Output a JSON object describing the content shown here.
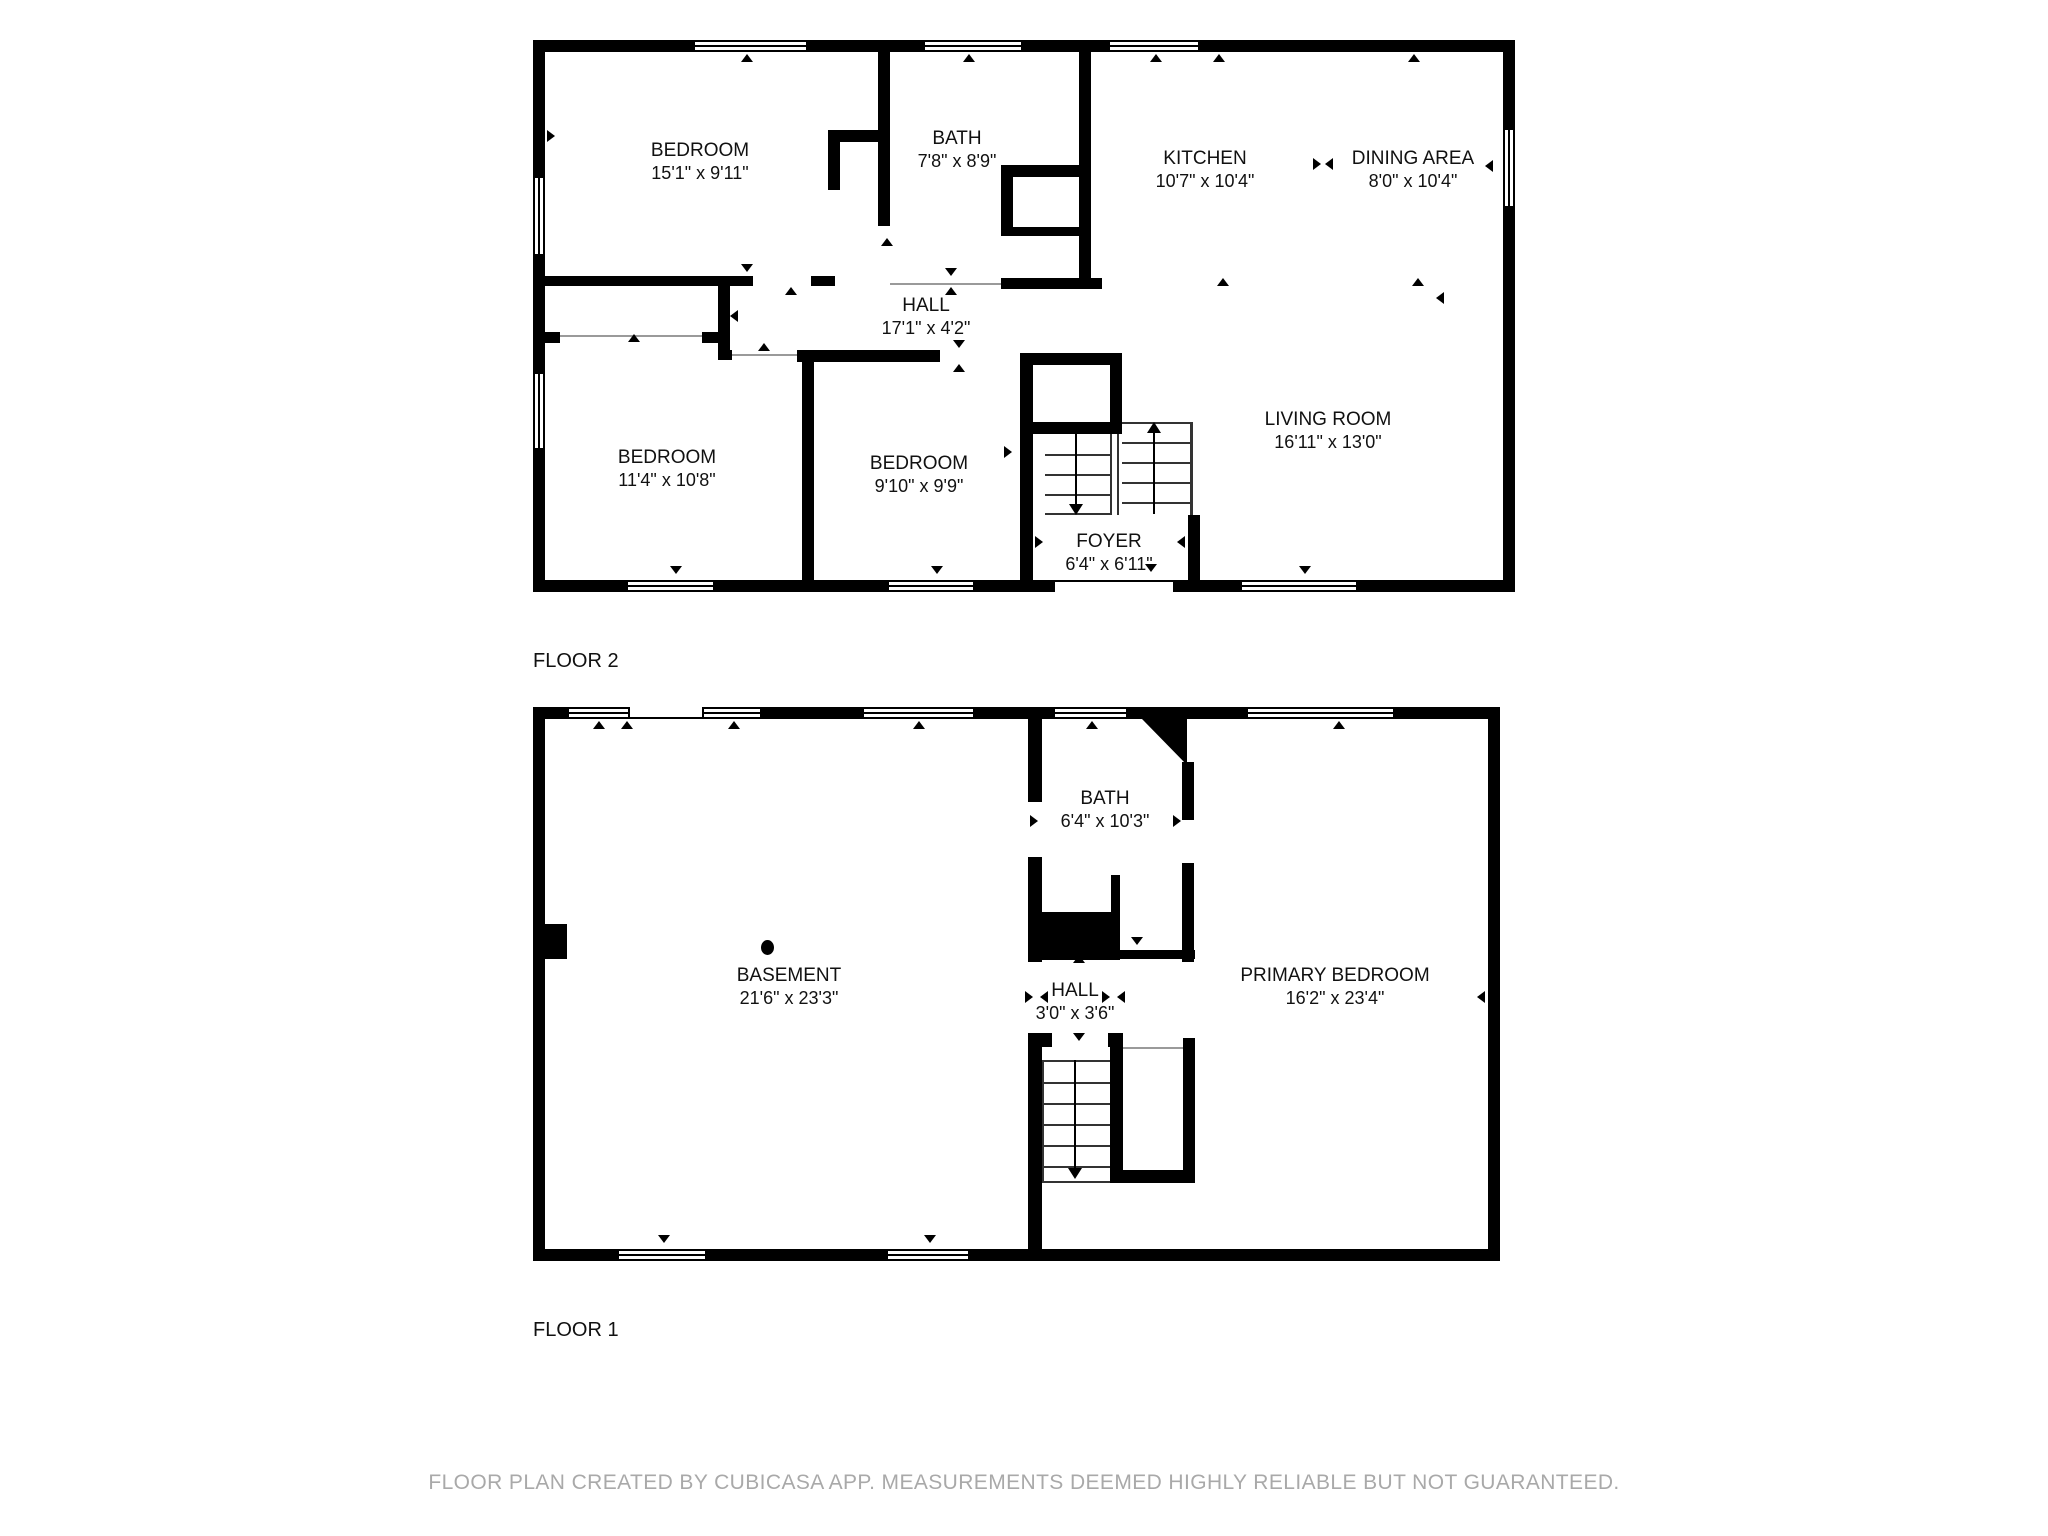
{
  "floors": [
    {
      "id": "floor-2",
      "label": "FLOOR 2",
      "rooms": [
        {
          "name": "BEDROOM",
          "dims": "15'1\" x 9'11\""
        },
        {
          "name": "BATH",
          "dims": "7'8\" x 8'9\""
        },
        {
          "name": "KITCHEN",
          "dims": "10'7\" x 10'4\""
        },
        {
          "name": "DINING AREA",
          "dims": "8'0\" x 10'4\""
        },
        {
          "name": "HALL",
          "dims": "17'1\" x 4'2\""
        },
        {
          "name": "BEDROOM",
          "dims": "11'4\" x 10'8\""
        },
        {
          "name": "BEDROOM",
          "dims": "9'10\" x 9'9\""
        },
        {
          "name": "LIVING ROOM",
          "dims": "16'11\" x 13'0\""
        },
        {
          "name": "FOYER",
          "dims": "6'4\" x 6'11\""
        }
      ]
    },
    {
      "id": "floor-1",
      "label": "FLOOR 1",
      "rooms": [
        {
          "name": "BATH",
          "dims": "6'4\" x 10'3\""
        },
        {
          "name": "BASEMENT",
          "dims": "21'6\" x 23'3\""
        },
        {
          "name": "HALL",
          "dims": "3'0\" x 3'6\""
        },
        {
          "name": "PRIMARY BEDROOM",
          "dims": "16'2\" x 23'4\""
        }
      ]
    }
  ],
  "footer": {
    "text": "FLOOR PLAN CREATED BY CUBICASA APP. MEASUREMENTS DEEMED HIGHLY RELIABLE BUT NOT GUARANTEED."
  },
  "colors": {
    "wall": "#000000",
    "background": "#ffffff",
    "label_text": "#111111",
    "footer_text": "#a9a9a9",
    "stair_line": "#333333"
  },
  "icons": {
    "window": "white-rect-double-line",
    "door-swing": "small-black-triangle",
    "dimension-tick": "small-black-triangle",
    "stair-up-arrow": "up-arrow",
    "stair-down-arrow": "down-arrow",
    "light-fixture": "black-dot"
  }
}
